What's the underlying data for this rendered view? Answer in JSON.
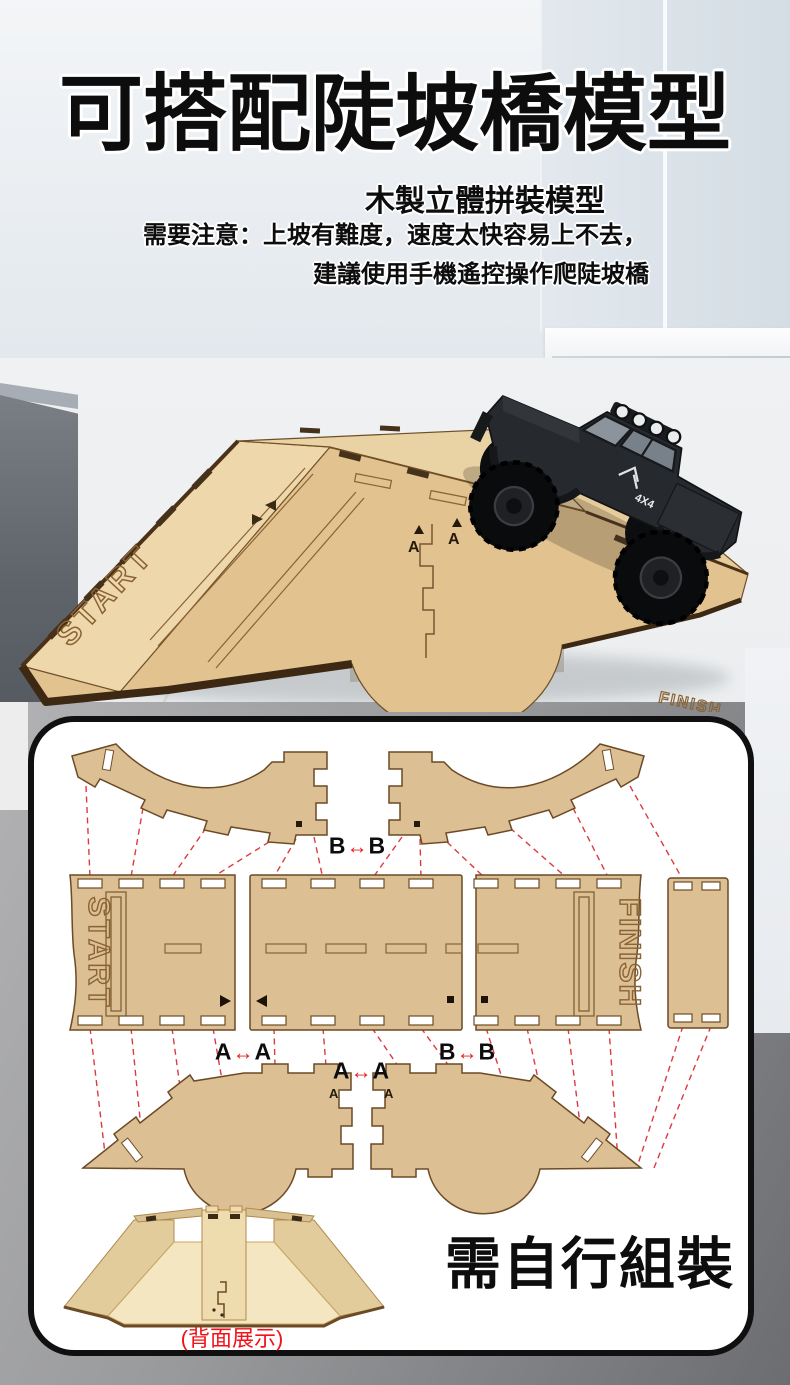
{
  "hero": {
    "title": "可搭配陡坡橋模型",
    "subtitle": "木製立體拼裝模型",
    "note_line1": "需要注意：上坡有難度，速度太快容易上不去，",
    "note_line2": "建議使用手機遙控操作爬陡坡橋",
    "ramp_start_text": "START",
    "ramp_finish_text": "FINISH",
    "seam_left": "A",
    "seam_right": "A",
    "truck_decal": "4X4"
  },
  "diagram": {
    "top_joint": {
      "left": "B",
      "arrow": "↔",
      "right": "B"
    },
    "mid_left_joint": {
      "left": "A",
      "arrow": "↔",
      "right": "A"
    },
    "mid_right_joint": {
      "left": "B",
      "arrow": "↔",
      "right": "B"
    },
    "lower_joint": {
      "left": "A",
      "arrow": "↔",
      "right": "A"
    },
    "start_panel_text": "START",
    "finish_panel_text": "FINISH",
    "rail_seam_left": "A",
    "rail_seam_right": "A"
  },
  "footer": {
    "back_view_caption": "(背面展示)",
    "assembly_note": "需自行組裝"
  },
  "colors": {
    "wood_light": "#ecd5a7",
    "wood_mid": "#dcbf92",
    "wood_edge": "#6b4a26",
    "trim_dark": "#3c2813",
    "dashed_red": "#d8262b",
    "caption_red": "#f3121a",
    "text_black": "#111111",
    "panel_border": "#101010"
  }
}
